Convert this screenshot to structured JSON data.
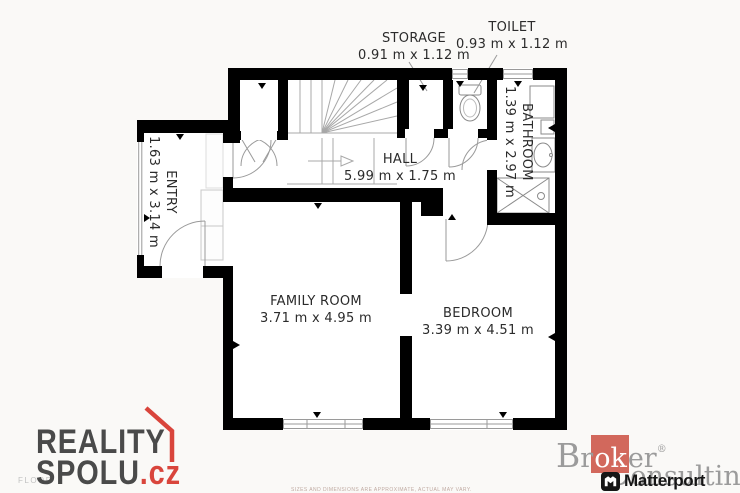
{
  "floorplan": {
    "wall_color": "#000000",
    "fixture_line_color": "#8a8a8a",
    "rooms": [
      {
        "name": "ENTRY",
        "dims": "1.63 m x 3.14 m"
      },
      {
        "name": "HALL",
        "dims": "5.99 m x 1.75 m"
      },
      {
        "name": "STORAGE",
        "dims": "0.91 m x 1.12 m"
      },
      {
        "name": "TOILET",
        "dims": "0.93 m x 1.12 m"
      },
      {
        "name": "BATHROOM",
        "dims": "1.39 m x 2.97 m"
      },
      {
        "name": "FAMILY ROOM",
        "dims": "3.71 m x 4.95 m"
      },
      {
        "name": "BEDROOM",
        "dims": "3.39 m x 4.51 m"
      }
    ],
    "floor_label": "FLOOR",
    "disclaimer": "SIZES AND DIMENSIONS ARE APPROXIMATE, ACTUAL MAY VARY."
  },
  "branding": {
    "reality_spolu": {
      "line1": "REALITY",
      "line2": "SPOLU",
      "tld": ".cz",
      "text_color": "#4a4a4a",
      "accent_color": "#d9453c"
    },
    "broker_consulting": {
      "prefix": "B",
      "prefix2": "r",
      "highlight": "ok",
      "suffix": "er",
      "registered": "®",
      "line2_cap": "C",
      "line2_rest": "onsulting",
      "text_color": "#9b9b9b",
      "square_color": "#d2685c"
    },
    "matterport": {
      "label": "Matterport",
      "color": "#161616"
    }
  }
}
